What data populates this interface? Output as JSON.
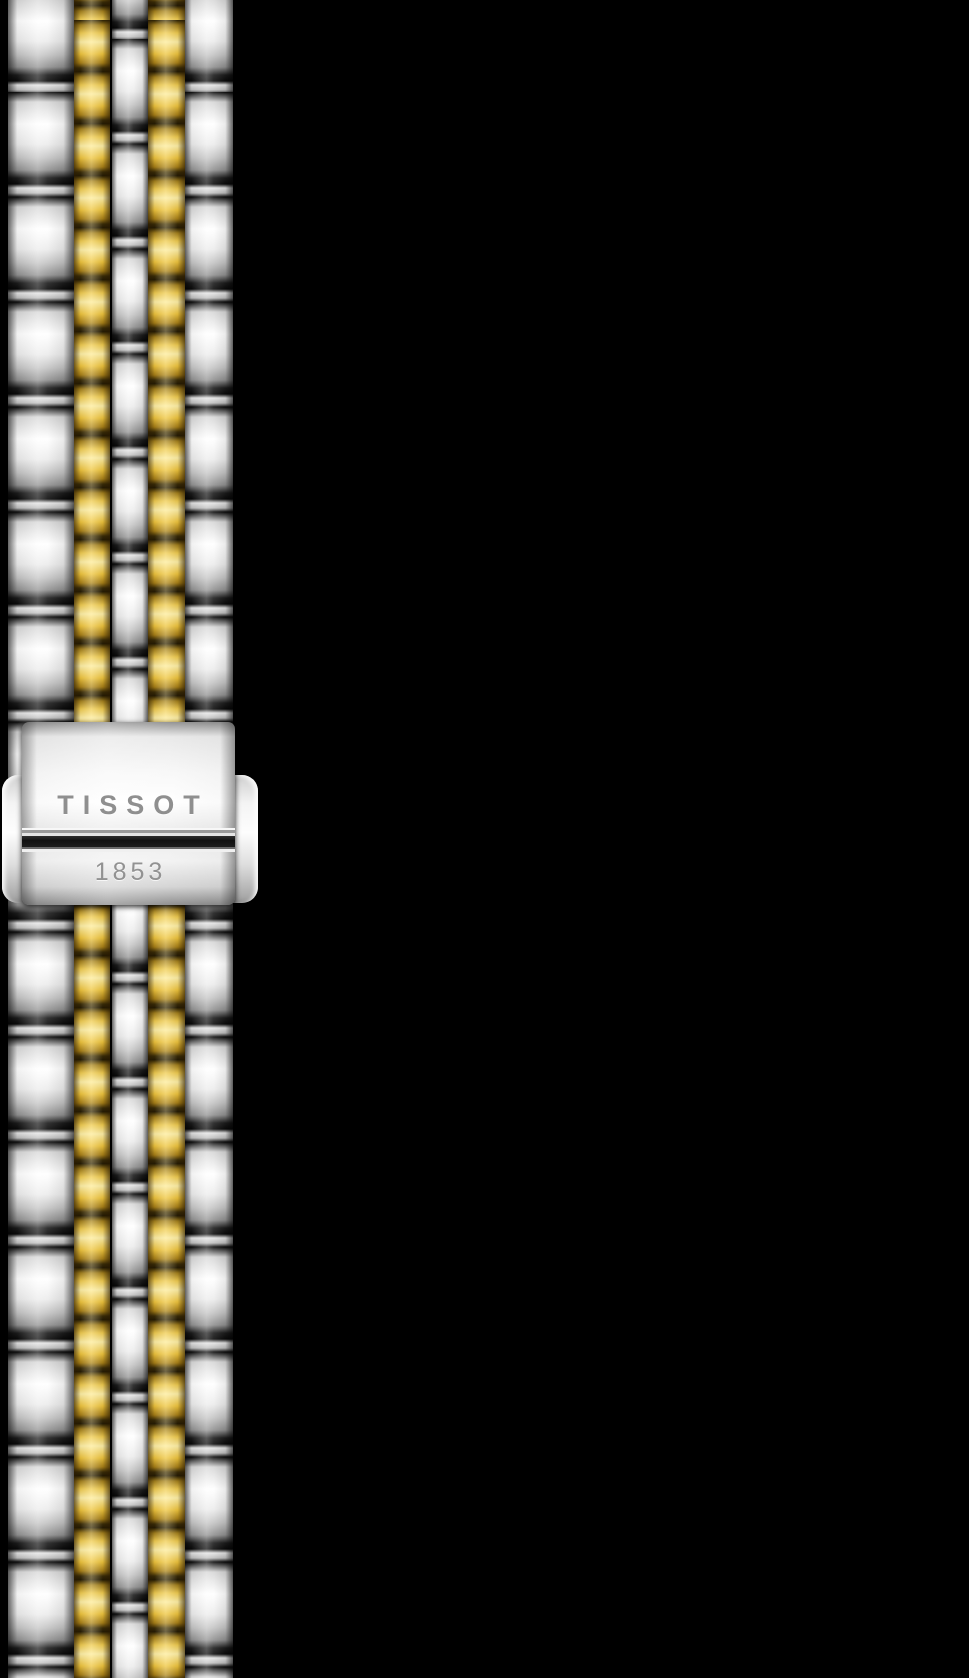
{
  "scene": {
    "description": "Two-tone stainless steel and yellow gold watch bracelet with engraved folding clasp, photographed vertically on a black background",
    "background_color": "#000000"
  },
  "clasp": {
    "brand_engraving": "TISSOT",
    "year_engraving": "1853",
    "engraving_color": "#8f8f8f",
    "metal_highlight": "#ffffff",
    "metal_shadow": "#8a8a8a"
  },
  "bracelet": {
    "style": "five-row link bracelet",
    "columns": [
      {
        "name": "outer-steel-left",
        "color": "steel"
      },
      {
        "name": "gold-left",
        "color": "gold"
      },
      {
        "name": "center-steel",
        "color": "steel"
      },
      {
        "name": "gold-right",
        "color": "gold"
      },
      {
        "name": "outer-steel-right",
        "color": "steel"
      }
    ],
    "colors": {
      "steel_highlight": "#ffffff",
      "steel_mid": "#c2c2c2",
      "steel_shadow": "#0c0c0c",
      "gold_highlight": "#fdeea6",
      "gold_mid": "#edc94f",
      "gold_shadow": "#2c2105"
    }
  }
}
